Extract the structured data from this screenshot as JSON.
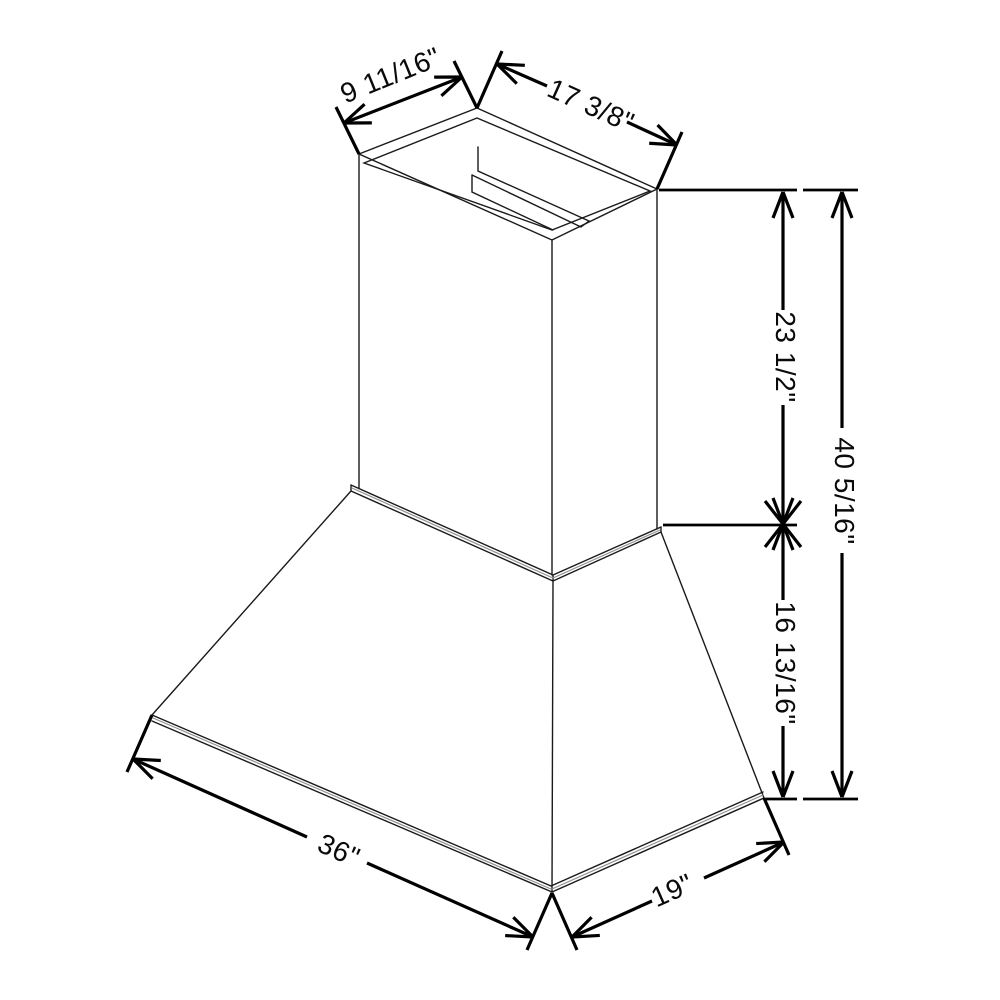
{
  "diagram": {
    "background": "#ffffff",
    "dimension_line_color": "#000000",
    "object_line_color": "#1a1a1a",
    "secondary_line_color": "#8f8f8f",
    "dimensions": {
      "top_width": "9 11/16\"",
      "top_depth": "17 3/8\"",
      "chimney_height": "23 1/2\"",
      "overall_height": "40 5/16\"",
      "hood_height": "16 13/16\"",
      "base_width": "36\"",
      "base_depth": "19\""
    }
  }
}
